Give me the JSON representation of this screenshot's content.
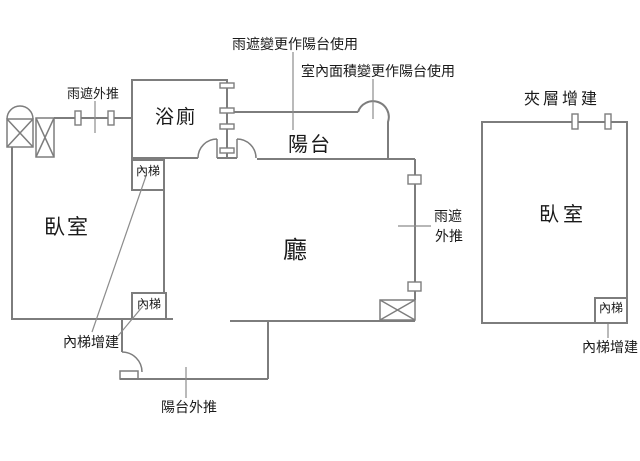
{
  "floor_plan": {
    "background_color": "#ffffff",
    "wall_color": "#7d7d7d",
    "text_color": "#1a1a1a",
    "leader_color": "#8c8c8c",
    "labels": {
      "canopy_change_to_balcony": "雨遮變更作陽台使用",
      "interior_area_change_to_balcony": "室內面積變更作陽台使用",
      "canopy_push_out_top_left": "雨遮外推",
      "mezzanine_addition": "夾層增建",
      "bathroom": "浴廁",
      "balcony": "陽台",
      "bedroom_left": "臥室",
      "bedroom_right": "臥室",
      "living_room": "廳",
      "inner_stairs_top": "內梯",
      "inner_stairs_bottom": "內梯",
      "inner_stairs_right": "內梯",
      "canopy_push_out_right_line1": "雨遮",
      "canopy_push_out_right_line2": "外推",
      "inner_stairs_addition_left": "內梯增建",
      "inner_stairs_addition_right": "內梯增建",
      "balcony_push_out": "陽台外推"
    }
  }
}
